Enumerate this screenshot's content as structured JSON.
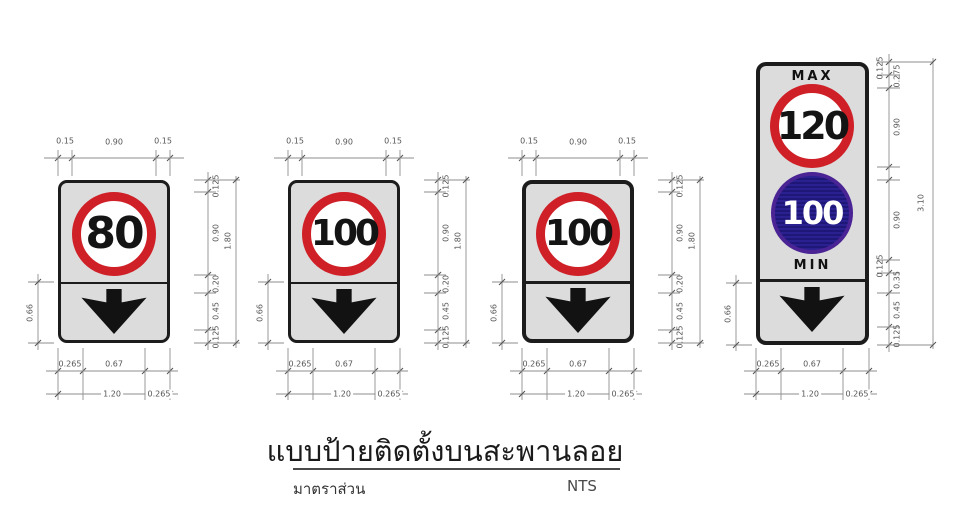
{
  "title_block": {
    "title": "แบบป้ายติดตั้งบนสะพานลอย",
    "scale_label": "มาตราส่วน",
    "scale_value": "NTS"
  },
  "colors": {
    "sign_background": "#dcdcdc",
    "sign_border": "#1c1c1c",
    "red_ring": "#cf2027",
    "blue_circle_fill": "#2b2090",
    "blue_circle_ring": "#4a2494",
    "arrow": "#121212",
    "dimension_lines": "#8e8e8e",
    "dimension_text": "#555555"
  },
  "signs": [
    {
      "name": "speed-limit-80",
      "speed": "80",
      "dims": {
        "top": [
          "0.15",
          "0.90",
          "0.15"
        ],
        "right": [
          "0.125",
          "0.90",
          "0.20",
          "0.45",
          "0.125"
        ],
        "right_total": "1.80",
        "left": "0.66",
        "bottom": [
          "0.265",
          "0.67"
        ],
        "bottom_total": "1.20",
        "bottom_right": "0.265"
      }
    },
    {
      "name": "speed-limit-100-a",
      "speed": "100",
      "dims": {
        "top": [
          "0.15",
          "0.90",
          "0.15"
        ],
        "right": [
          "0.125",
          "0.90",
          "0.20",
          "0.45",
          "0.125"
        ],
        "right_total": "1.80",
        "left": "0.66",
        "bottom": [
          "0.265",
          "0.67"
        ],
        "bottom_total": "1.20",
        "bottom_right": "0.265"
      }
    },
    {
      "name": "speed-limit-100-b",
      "speed": "100",
      "dims": {
        "top": [
          "0.15",
          "0.90",
          "0.15"
        ],
        "right": [
          "0.125",
          "0.90",
          "0.20",
          "0.45",
          "0.125"
        ],
        "right_total": "1.80",
        "left": "0.66",
        "bottom": [
          "0.265",
          "0.67"
        ],
        "bottom_total": "1.20",
        "bottom_right": "0.265"
      }
    },
    {
      "name": "max-min-speed",
      "max_label": "MAX",
      "max_speed": "120",
      "min_speed": "100",
      "min_label": "MIN",
      "dims": {
        "right": [
          "0.125",
          "0.275",
          "0.90",
          "0.90",
          "0.125",
          "0.35",
          "0.45",
          "0.125"
        ],
        "right_total": "3.10",
        "left": "0.66",
        "bottom": [
          "0.265",
          "0.67"
        ],
        "bottom_total": "1.20",
        "bottom_right": "0.265"
      }
    }
  ]
}
